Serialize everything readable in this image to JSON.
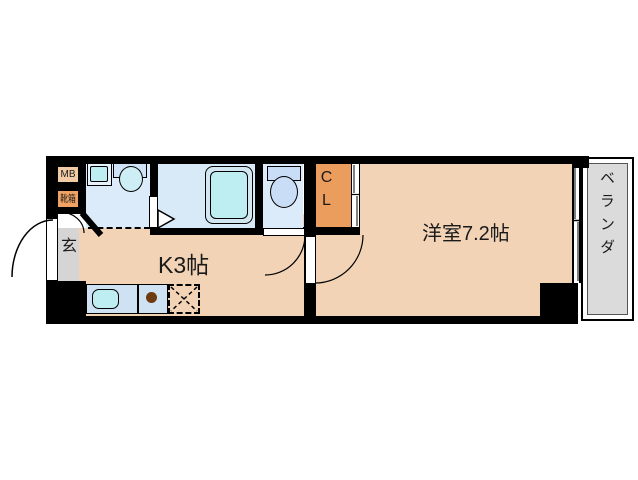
{
  "floorplan": {
    "rooms": {
      "meter_box": {
        "label": "MB"
      },
      "shoe_box": {
        "label": "靴箱"
      },
      "entrance": {
        "label": "玄"
      },
      "kitchen": {
        "label": "K3帖"
      },
      "western_room": {
        "label": "洋室7.2帖"
      },
      "closet": {
        "label": "CL"
      },
      "veranda": {
        "label": "ベランダ"
      }
    },
    "colors": {
      "wall": "#000000",
      "room_tan": "#f2d3b6",
      "wet_area_blue": "#dcebf9",
      "fixture_cyan": "#bfeef2",
      "closet_orange": "#eb9d5e",
      "shoe_box_orange": "#efa263",
      "meter_box_tan": "#f0cba6",
      "entrance_gray": "#d5d5d5",
      "veranda_gray": "#dbdbdb"
    }
  }
}
